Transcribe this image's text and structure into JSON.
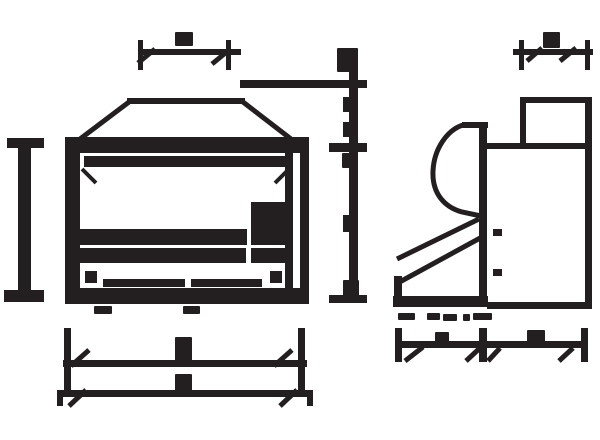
{
  "colors": {
    "ink": "#231f20",
    "background": "#ffffff"
  },
  "drawing": {
    "kind": "technical-drawing",
    "views": [
      {
        "id": "front-view"
      },
      {
        "id": "side-view"
      }
    ],
    "dimensions": [
      {
        "id": "front-top-width-dimension",
        "label_legible": false
      },
      {
        "id": "front-height-dimension-left",
        "label_legible": false
      },
      {
        "id": "center-height-scale",
        "label_legible": false
      },
      {
        "id": "front-bottom-width-dimension-1",
        "label_legible": false
      },
      {
        "id": "front-bottom-width-dimension-2",
        "label_legible": false
      },
      {
        "id": "side-top-depth-dimension",
        "label_legible": false
      },
      {
        "id": "side-bottom-depth-dimension",
        "label_legible": false
      }
    ]
  }
}
